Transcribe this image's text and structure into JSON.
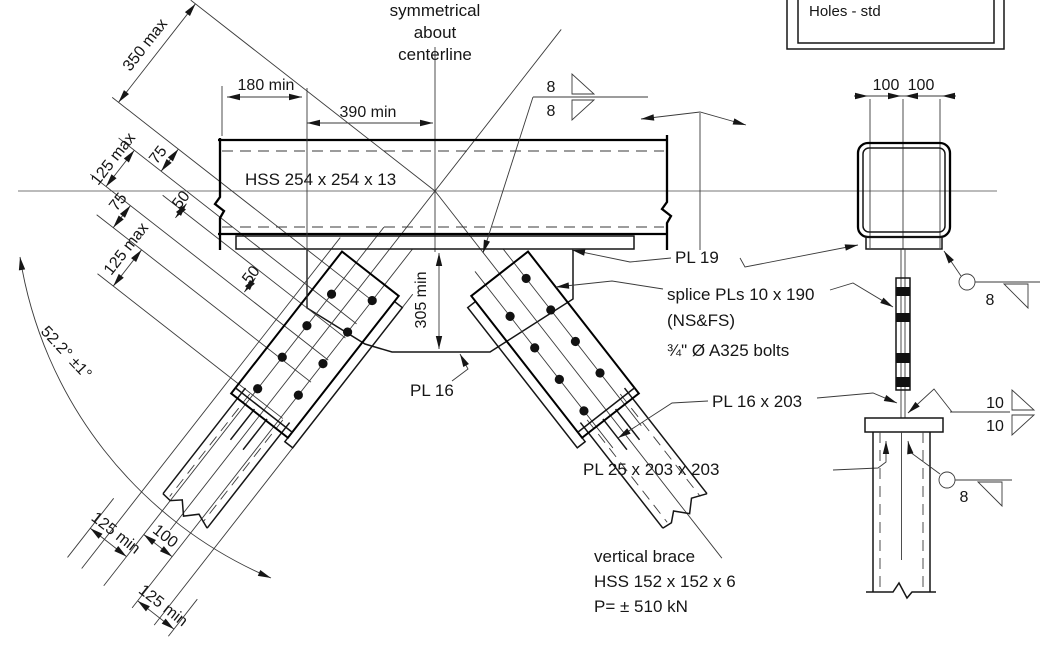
{
  "title": "Steel vertical brace connection detail",
  "notes": {
    "holes": "Holes - std",
    "sym1": "symmetrical",
    "sym2": "about",
    "sym3": "centerline"
  },
  "members": {
    "beam": "HSS 254 x 254 x 13",
    "brace1": "vertical brace",
    "brace2": "HSS 152 x 152 x 6",
    "brace3": "P= ± 510 kN"
  },
  "plates": {
    "pl19": "PL 19",
    "splice1": "splice PLs 10 x 190",
    "splice2": "(NS&FS)",
    "bolts": "¾\" Ø A325 bolts",
    "pl16": "PL 16",
    "pl16x203": "PL 16 x 203",
    "pl25": "PL 25 x 203 x 203"
  },
  "dims": {
    "d350": "350 max",
    "d180": "180 min",
    "d390": "390 min",
    "d125max": "125 max",
    "d75": "75",
    "d50": "50",
    "d305": "305 min",
    "d100": "100",
    "d125min": "125 min",
    "angle": "52.2° ±1°"
  },
  "welds": {
    "w8": "8",
    "w10": "10"
  },
  "colors": {
    "plate_highlight": "#ffee00"
  }
}
